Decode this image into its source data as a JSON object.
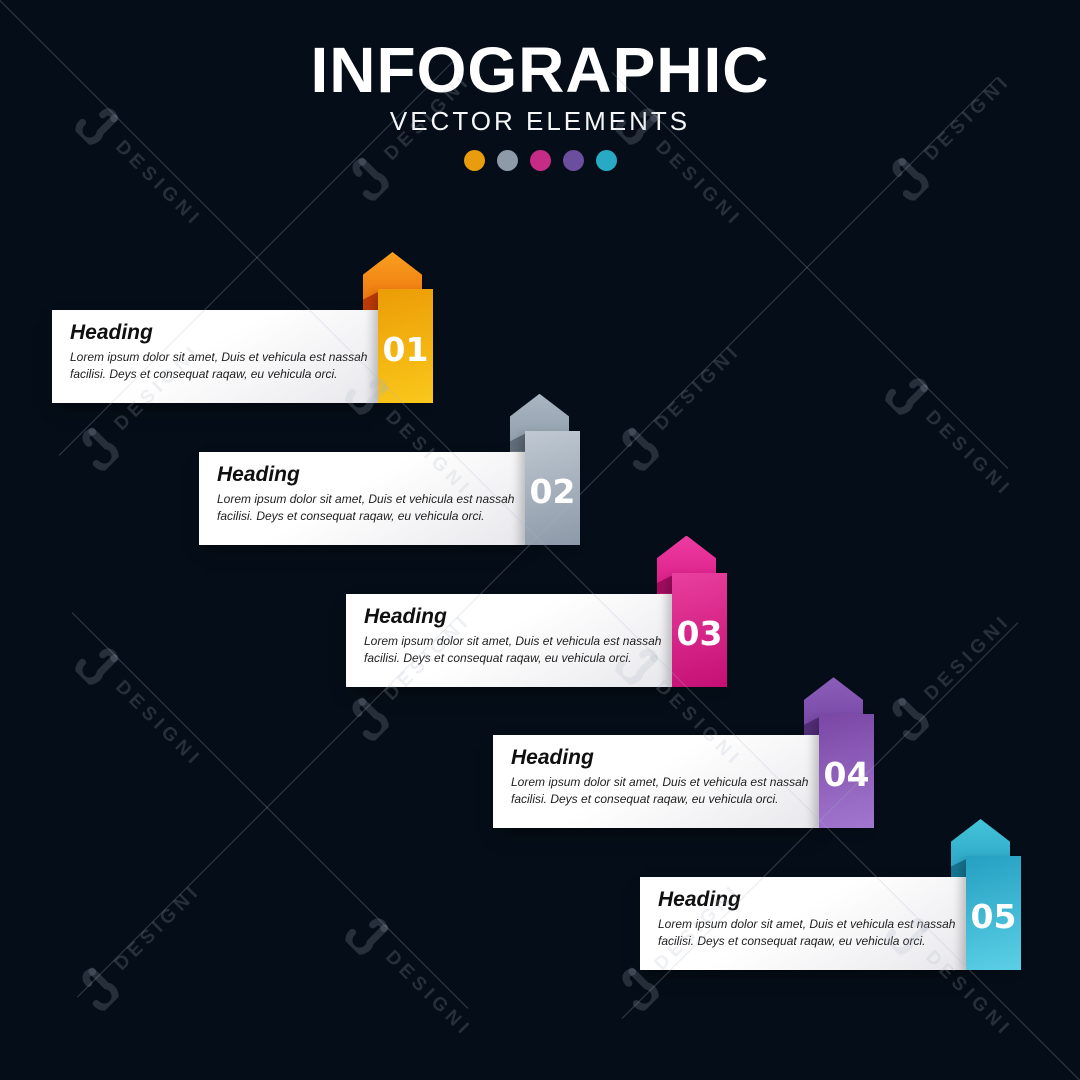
{
  "background_color": "#050e18",
  "header": {
    "title": "INFOGRAPHIC",
    "subtitle": "VECTOR ELEMENTS",
    "dot_colors": [
      "#e89c0e",
      "#8d9aa7",
      "#c62c86",
      "#6c4e9e",
      "#28a9c4"
    ]
  },
  "steps": [
    {
      "number": "01",
      "heading": "Heading",
      "body": "Lorem ipsum dolor sit amet, Duis et vehicula est nassah facilisi. Deys et consequat raqaw, eu vehicula orci.",
      "arrow_top": "#f9a01f",
      "arrow_bottom": "#ea5f07",
      "fold": "#c23d08",
      "bar_top": "#ec9c06",
      "bar_bottom": "#fac81b"
    },
    {
      "number": "02",
      "heading": "Heading",
      "body": "Lorem ipsum dolor sit amet, Duis et vehicula est nassah facilisi. Deys et consequat raqaw, eu vehicula orci.",
      "arrow_top": "#aab6c2",
      "arrow_bottom": "#8391a0",
      "fold": "#626e7c",
      "bar_top": "#c0c9d2",
      "bar_bottom": "#8c99a8"
    },
    {
      "number": "03",
      "heading": "Heading",
      "body": "Lorem ipsum dolor sit amet, Duis et vehicula est nassah facilisi. Deys et consequat raqaw, eu vehicula orci.",
      "arrow_top": "#ee3ba2",
      "arrow_bottom": "#d0107a",
      "fold": "#a30d61",
      "bar_top": "#e93f9e",
      "bar_bottom": "#c50f74"
    },
    {
      "number": "04",
      "heading": "Heading",
      "body": "Lorem ipsum dolor sit amet, Duis et vehicula est nassah facilisi. Deys et consequat raqaw, eu vehicula orci.",
      "arrow_top": "#8c5eb9",
      "arrow_bottom": "#6d3d9d",
      "fold": "#532f7a",
      "bar_top": "#7a47a4",
      "bar_bottom": "#a277cf"
    },
    {
      "number": "05",
      "heading": "Heading",
      "body": "Lorem ipsum dolor sit amet, Duis et vehicula est nassah facilisi. Deys et consequat raqaw, eu vehicula orci.",
      "arrow_top": "#44c4db",
      "arrow_bottom": "#1f95b7",
      "fold": "#177795",
      "bar_top": "#25a0c2",
      "bar_bottom": "#5bcfe6"
    }
  ],
  "watermark": {
    "label": "DESIGNI",
    "logo": "designi-d-logo"
  }
}
